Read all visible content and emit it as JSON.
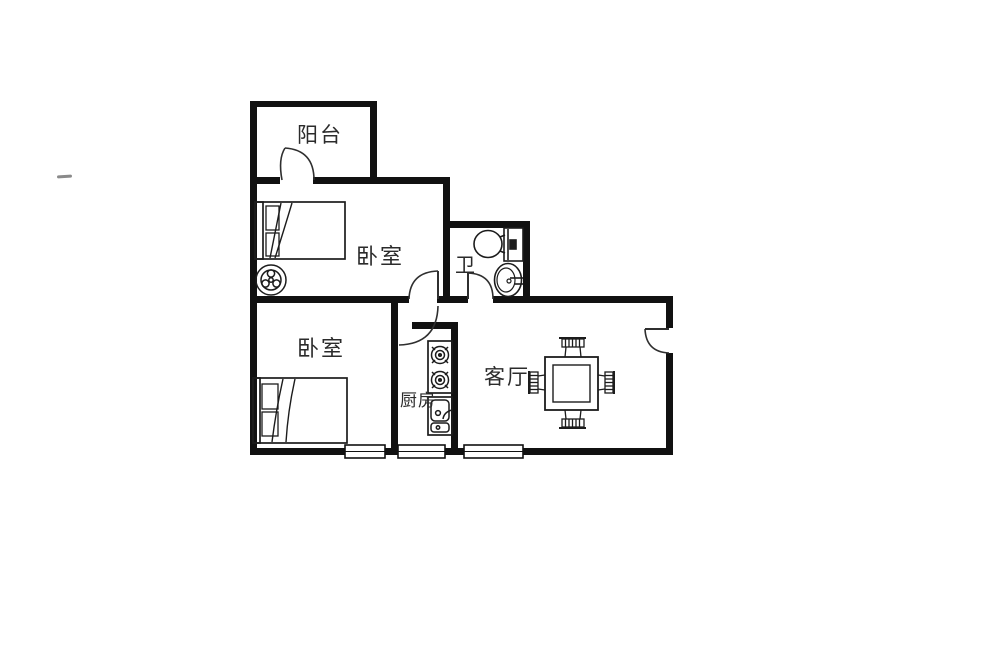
{
  "page": {
    "background_color": "#ffffff",
    "wall_color": "#111111",
    "furniture_line_color": "#1c1c1c",
    "label_color": "#2b2b2b"
  },
  "floor_plan": {
    "type": "apartment-floor-plan",
    "rooms": [
      {
        "id": "balcony",
        "label": "阳台"
      },
      {
        "id": "bedroom-top",
        "label": "卧室"
      },
      {
        "id": "bathroom",
        "label": "卫"
      },
      {
        "id": "bedroom-bottom",
        "label": "卧室"
      },
      {
        "id": "kitchen",
        "label": "厨房"
      },
      {
        "id": "living-room",
        "label": "客厅"
      }
    ],
    "furniture": [
      "double-bed-icon",
      "fan-icon",
      "double-bed-icon",
      "toilet-icon",
      "wash-basin-icon",
      "gas-stove-icon",
      "kitchen-sink-icon",
      "dining-table-icon",
      "chair-icon"
    ],
    "door_count": 5,
    "window_count": 3
  }
}
